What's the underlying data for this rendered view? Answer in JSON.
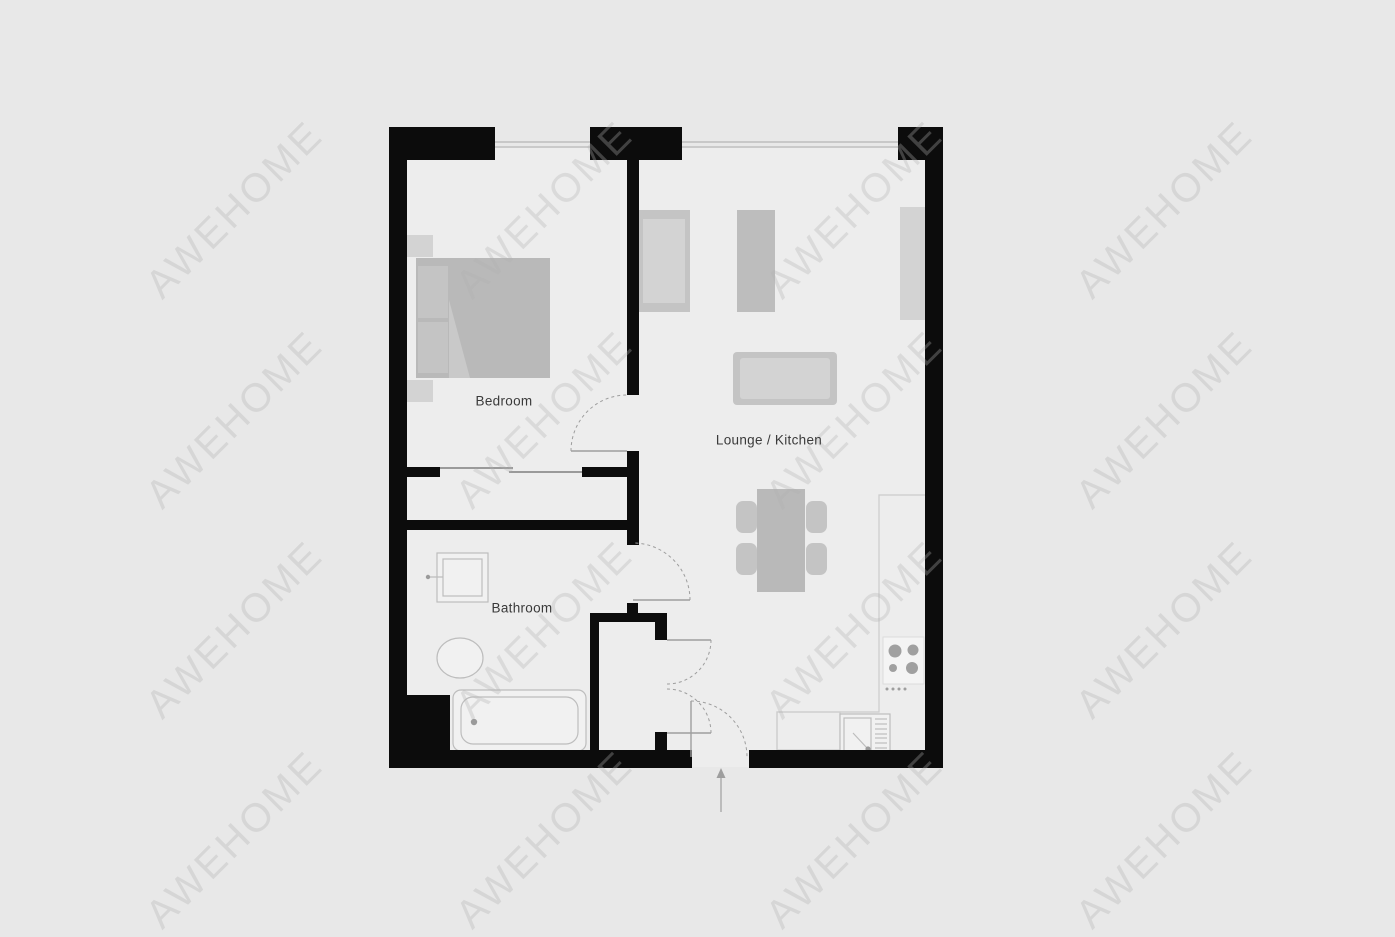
{
  "watermark": {
    "text": "AWEHOME"
  },
  "rooms": {
    "bedroom": {
      "label": "Bedroom"
    },
    "lounge_kitchen": {
      "label": "Lounge / Kitchen"
    },
    "bathroom": {
      "label": "Bathroom"
    }
  },
  "colors": {
    "page-bg": "#e8e8e8",
    "floor": "#ededed",
    "wall": "#0c0c0c",
    "furniture-dark": "#b9b9b9",
    "furniture-mid": "#c4c4c4",
    "furniture-light": "#d3d3d3",
    "fixture-fill": "#f1f1f1",
    "fixture-stroke": "#bdbdbd",
    "door-line": "#9e9e9e",
    "window-line": "#b5b5b5",
    "counter-line": "#cccccc",
    "label-text": "#3a3a3a",
    "watermark-text": "rgba(178,178,178,0.32)"
  }
}
